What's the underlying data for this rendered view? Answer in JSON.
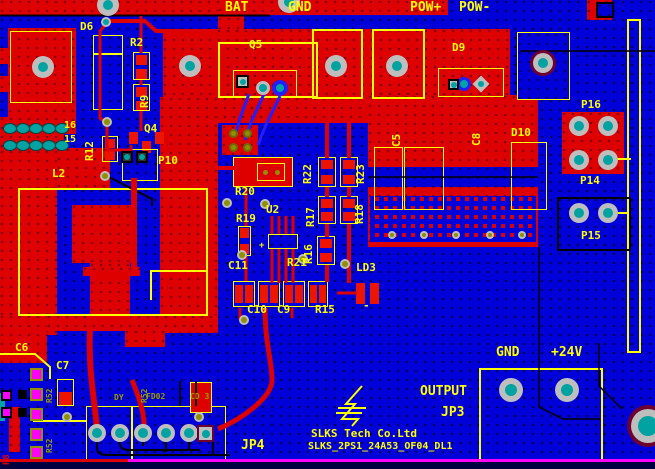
{
  "app": {
    "type": "pcb-layout-editor-canvas"
  },
  "nets": {
    "bat": "BAT",
    "gnd_top": "GND",
    "pow_plus": "POW+",
    "pow_minus": "POW-",
    "gnd_out": "GND",
    "v24": "+24V",
    "output": "OUTPUT"
  },
  "designators": {
    "d6": "D6",
    "r2": "R2",
    "r9": "R9",
    "q4": "Q4",
    "r12": "R12",
    "p10": "P10",
    "l2": "L2",
    "q5": "Q5",
    "d9": "D9",
    "c5": "C5",
    "c8": "C8",
    "d10": "D10",
    "p16": "P16",
    "p14": "P14",
    "p15": "P15",
    "r20": "R20",
    "r19": "R19",
    "u2": "U2",
    "r22": "R22",
    "r23": "R23",
    "r17": "R17",
    "r18": "R18",
    "r16": "R16",
    "c11": "C11",
    "r21": "R21",
    "ld3": "LD3",
    "c10": "C10",
    "c9": "C9",
    "r15": "R15",
    "c6": "C6",
    "c7": "C7",
    "jp4": "JP4",
    "jp3": "JP3",
    "r8": "R8"
  },
  "connector_pins": {
    "pin16": "16",
    "pin15": "15"
  },
  "titleblock": {
    "company": "SLKS Tech Co.Ltd",
    "part_number": "SLKS_2PS1_24A53_OF04_DL1"
  },
  "bottom_silk": {
    "r52a": "R52",
    "r52b": "R52",
    "r52c": "R52",
    "dy": "DY",
    "fd02": "FD02",
    "cd3": "CD 3"
  },
  "marks": {
    "u2_plus": "+",
    "ld3_minus": "-"
  },
  "colors": {
    "board_blue": "#0000D8",
    "copper_red": "#DE0000",
    "silk_yellow": "#FFFF00",
    "bottom_silk_olive": "#9C9C00",
    "pad_teal": "#00A2A2",
    "pad_ring_gray": "#BEBEBE",
    "via_olive": "#8F8F00",
    "keepout_magenta": "#FF00FF",
    "maroon": "#6E0030",
    "bottom_trace_blue": "#2020FF"
  }
}
